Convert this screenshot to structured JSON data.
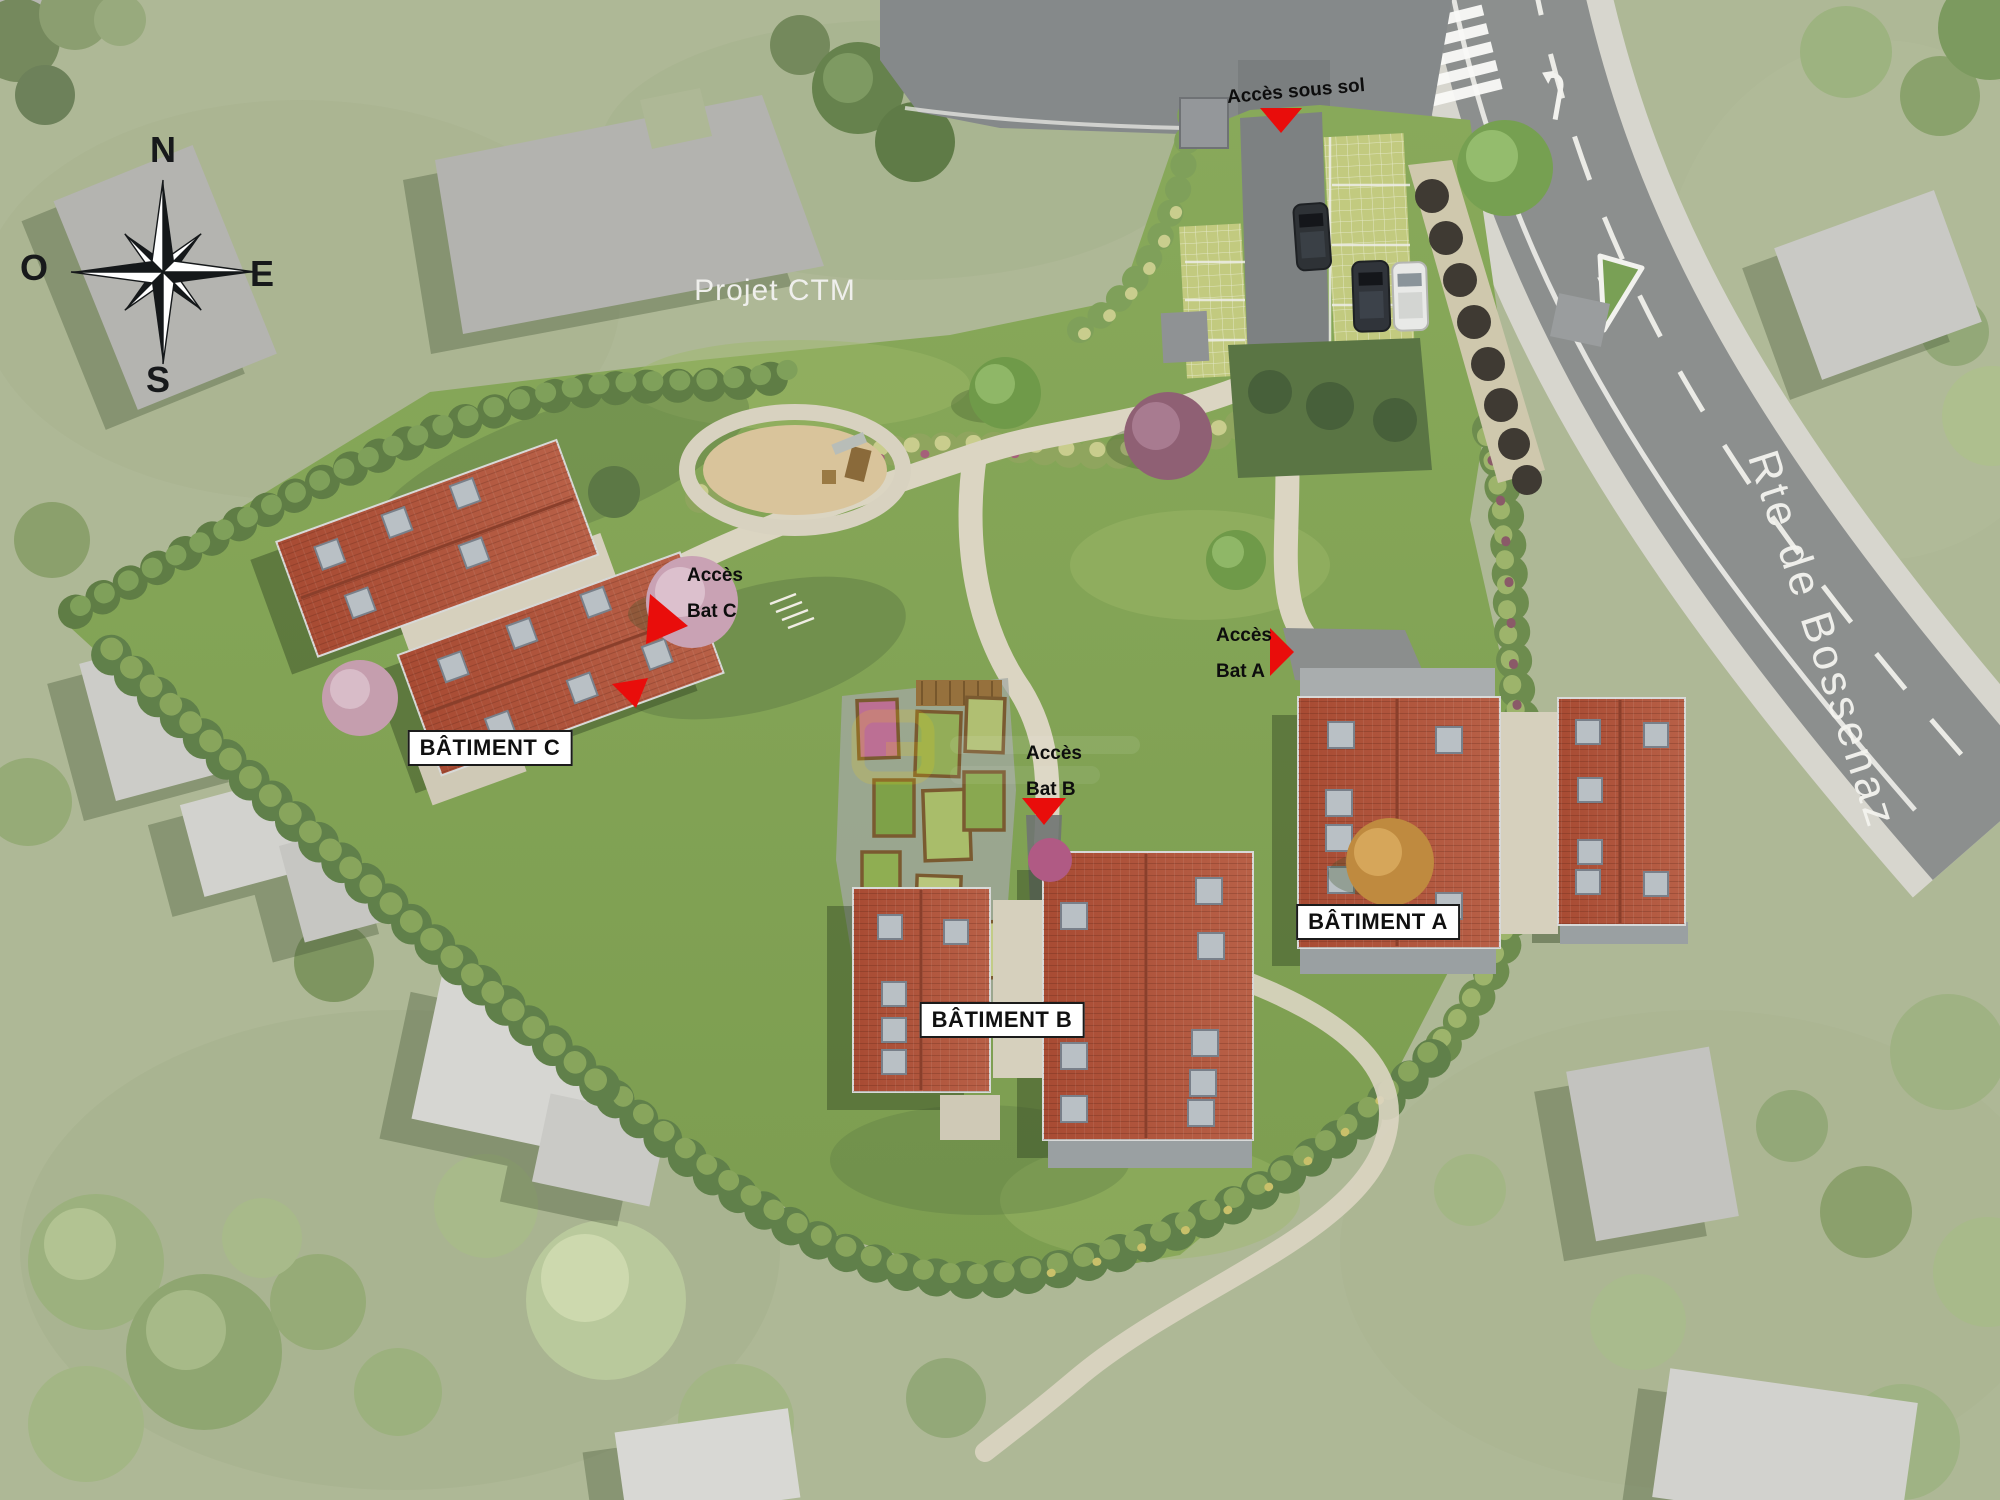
{
  "compass": {
    "north": "N",
    "west": "O",
    "east": "E",
    "south": "S"
  },
  "surroundings": {
    "neighbor_project_label": "Projet CTM",
    "road_name": "Rte de Bossenaz"
  },
  "access_markers": {
    "basement": {
      "label": "Accès sous sol"
    },
    "bat_a": {
      "line1": "Accès",
      "line2": "Bat A"
    },
    "bat_b": {
      "line1": "Accès",
      "line2": "Bat B"
    },
    "bat_c": {
      "line1": "Accès",
      "line2": "Bat C"
    }
  },
  "buildings": {
    "a": {
      "label": "BÂTIMENT A"
    },
    "b": {
      "label": "BÂTIMENT B"
    },
    "c": {
      "label": "BÂTIMENT C"
    }
  },
  "colors": {
    "marker_red": "#e90d0b",
    "roof_red": "#b0523a",
    "site_grass_green": "#83a455",
    "surrounding_grass_green": "#aeb896",
    "road_gray": "#8c8f8e",
    "path_beige": "#d9d3c0",
    "neighbor_building_gray": "#c2c2be",
    "label_box_background": "#ffffff",
    "label_text": "#111111"
  }
}
